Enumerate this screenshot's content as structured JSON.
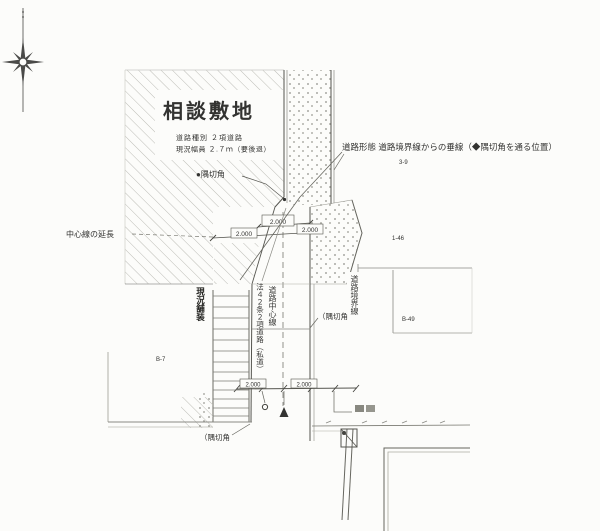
{
  "site": {
    "name": "相談敷地",
    "note1": "道路種別 ２項道路",
    "note2": "現況幅員 ２.７ｍ（要後退）"
  },
  "annotations": {
    "perpendicular_note": "道路形態 道路境界線からの垂線（◆隅切角を通る位置）",
    "corner_cut_top": "●隅切角",
    "centerline_extension": "中心線の延長",
    "corner_cut_mid": "（隅切角",
    "corner_cut_bottom": "（隅切角"
  },
  "vertical_labels": {
    "road_law": "法４２条２項道路（私道）",
    "road_centerline": "道路中心線",
    "road_boundary": "道路境界線",
    "pavement": "現況舗装"
  },
  "lot_numbers": {
    "n1": "3-9",
    "n2": "1-46",
    "n3": "B-49",
    "n4": "B-7"
  },
  "dimensions": {
    "d1": "2.000",
    "d2": "2.000",
    "d3": "2.000",
    "d4": "2.000",
    "d5": "2.000"
  },
  "colors": {
    "paper": "#fcfcfa",
    "line": "#4a4a48",
    "hatch": "#bcbcb6",
    "stipple": "#8f8f88",
    "text": "#2f2f2d"
  }
}
